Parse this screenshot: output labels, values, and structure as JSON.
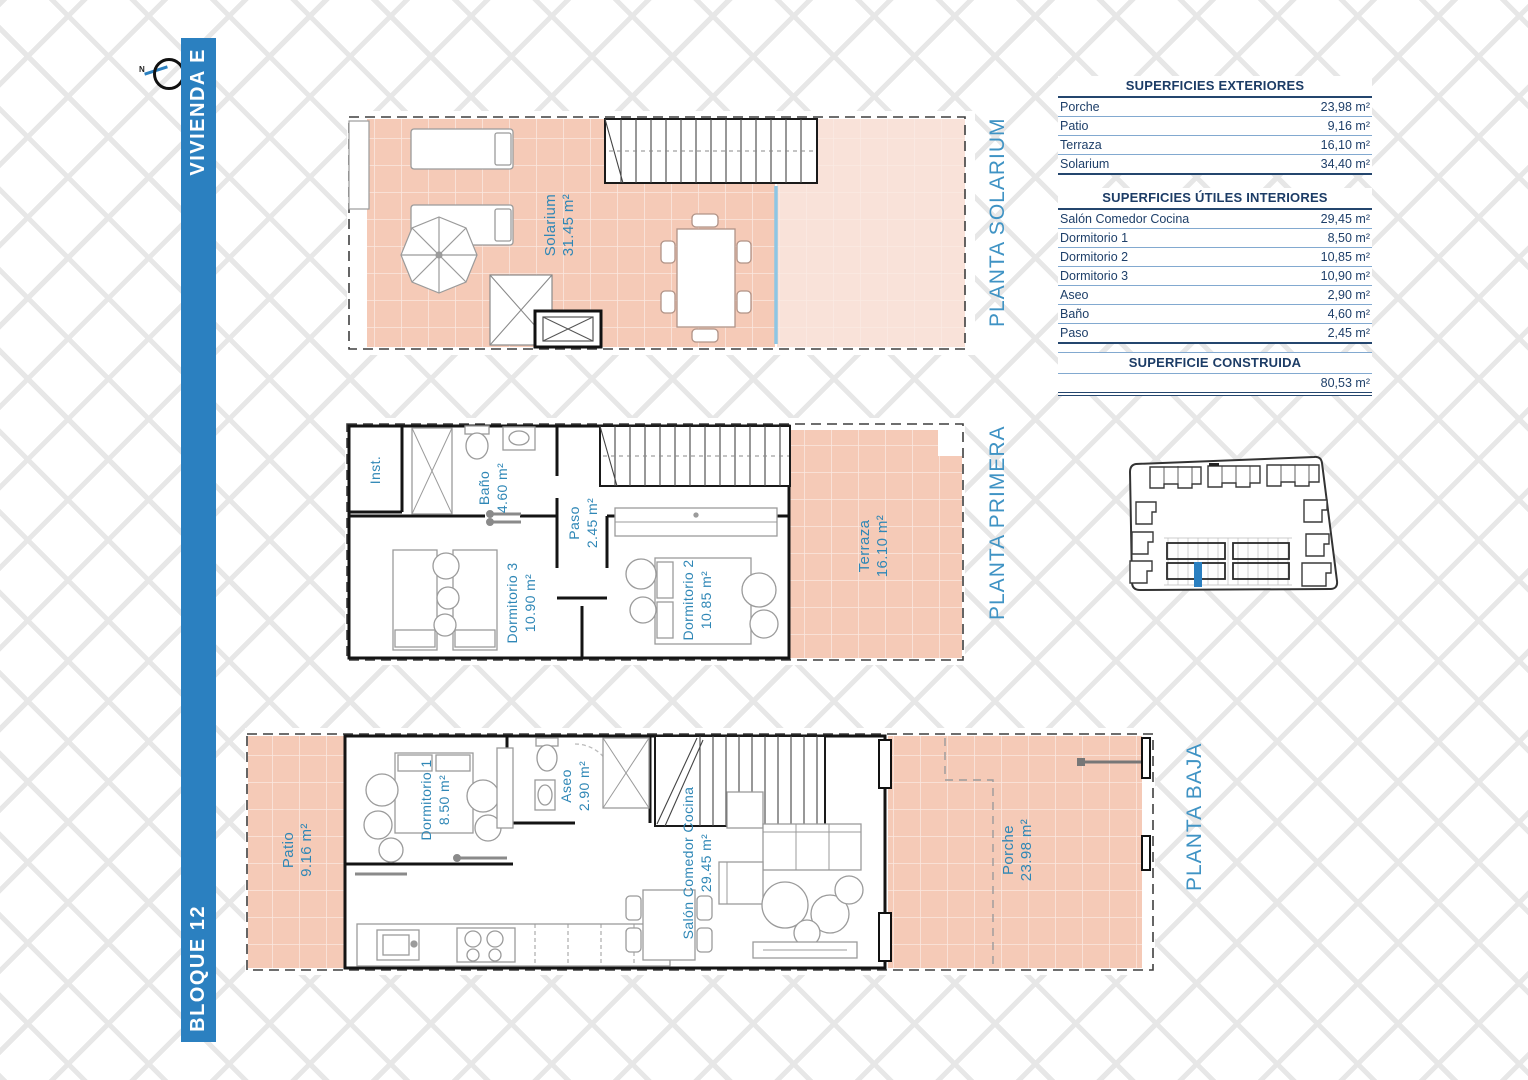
{
  "compass": {
    "north_label": "N"
  },
  "sidebar": {
    "vivienda_label": "VIVIENDA E",
    "bloque_label": "BLOQUE 12"
  },
  "plans": {
    "solarium": {
      "title": "PLANTA SOLARIUM",
      "rooms": {
        "solarium": {
          "name": "Solarium",
          "area": "31.45 m²"
        }
      }
    },
    "primera": {
      "title": "PLANTA PRIMERA",
      "rooms": {
        "inst": {
          "name": "Inst."
        },
        "bano": {
          "name": "Baño",
          "area": "4.60 m²"
        },
        "paso": {
          "name": "Paso",
          "area": "2.45 m²"
        },
        "dormitorio3": {
          "name": "Dormitorio 3",
          "area": "10.90 m²"
        },
        "dormitorio2": {
          "name": "Dormitorio 2",
          "area": "10.85 m²"
        },
        "terraza": {
          "name": "Terraza",
          "area": "16.10 m²"
        }
      }
    },
    "baja": {
      "title": "PLANTA BAJA",
      "rooms": {
        "patio": {
          "name": "Patio",
          "area": "9.16 m²"
        },
        "dormitorio1": {
          "name": "Dormitorio 1",
          "area": "8.50 m²"
        },
        "aseo": {
          "name": "Aseo",
          "area": "2.90 m²"
        },
        "salon": {
          "name": "Salón Comedor Cocina",
          "area": "29.45 m²"
        },
        "porche": {
          "name": "Porche",
          "area": "23.98 m²"
        }
      }
    }
  },
  "tables": {
    "exteriores": {
      "title": "SUPERFICIES EXTERIORES",
      "rows": [
        {
          "label": "Porche",
          "value": "23,98 m²"
        },
        {
          "label": "Patio",
          "value": "9,16 m²"
        },
        {
          "label": "Terraza",
          "value": "16,10 m²"
        },
        {
          "label": "Solarium",
          "value": "34,40 m²"
        }
      ]
    },
    "interiores": {
      "title": "SUPERFICIES ÚTILES INTERIORES",
      "rows": [
        {
          "label": "Salón Comedor Cocina",
          "value": "29,45 m²"
        },
        {
          "label": "Dormitorio 1",
          "value": "8,50 m²"
        },
        {
          "label": "Dormitorio 2",
          "value": "10,85 m²"
        },
        {
          "label": "Dormitorio 3",
          "value": "10,90 m²"
        },
        {
          "label": "Aseo",
          "value": "2,90 m²"
        },
        {
          "label": "Baño",
          "value": "4,60 m²"
        },
        {
          "label": "Paso",
          "value": "2,45 m²"
        }
      ]
    },
    "construida": {
      "title": "SUPERFICIE CONSTRUIDA",
      "value": "80,53 m²"
    }
  },
  "colors": {
    "accent_blue": "#2b80c0",
    "room_label_blue": "#2f87b6",
    "planta_label_blue": "#3f93c4",
    "table_navy": "#1e3f69",
    "salmon": "#f5cab7",
    "salmon_light": "#f9e2d9",
    "highlight_blue": "#2a7fc0"
  }
}
